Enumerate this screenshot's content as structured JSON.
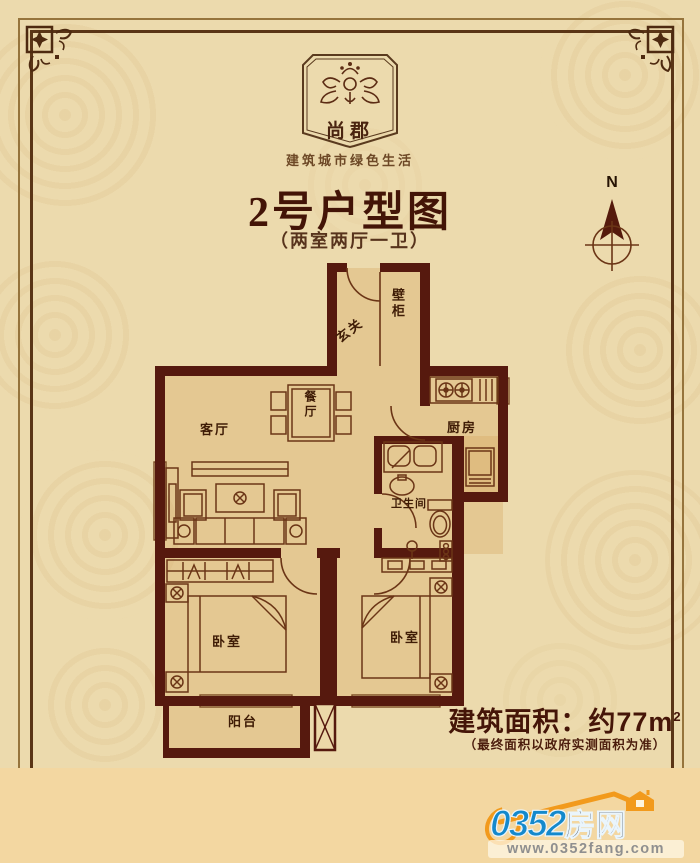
{
  "brand": {
    "logo_text": "尚郡",
    "slogan": "建筑城市绿色生活"
  },
  "header": {
    "title": "2号户型图",
    "subtitle": "（两室两厅一卫）"
  },
  "compass": {
    "label": "N"
  },
  "floorplan": {
    "rooms": {
      "entry": "玄关",
      "closet": "壁柜",
      "living": "客厅",
      "dining": "餐厅",
      "kitchen": "厨房",
      "bathroom": "卫生间",
      "bedroom_left": "卧室",
      "bedroom_right": "卧室",
      "balcony": "阳台"
    }
  },
  "footer": {
    "area_text": "建筑面积：约77m",
    "area_sup": "2",
    "area_note": "（最终面积以政府实测面积为准）"
  },
  "watermark": {
    "number": "0352",
    "name": "房网",
    "url": "www.0352fang.com"
  },
  "colors": {
    "background": "#ecdaad",
    "bottom_strip": "#f3d7a1",
    "wall": "#56190e",
    "furniture_line": "#6b3516",
    "title_text": "#431407",
    "watermark_blue": "#1489cc",
    "watermark_orange": "#f29a1c"
  }
}
